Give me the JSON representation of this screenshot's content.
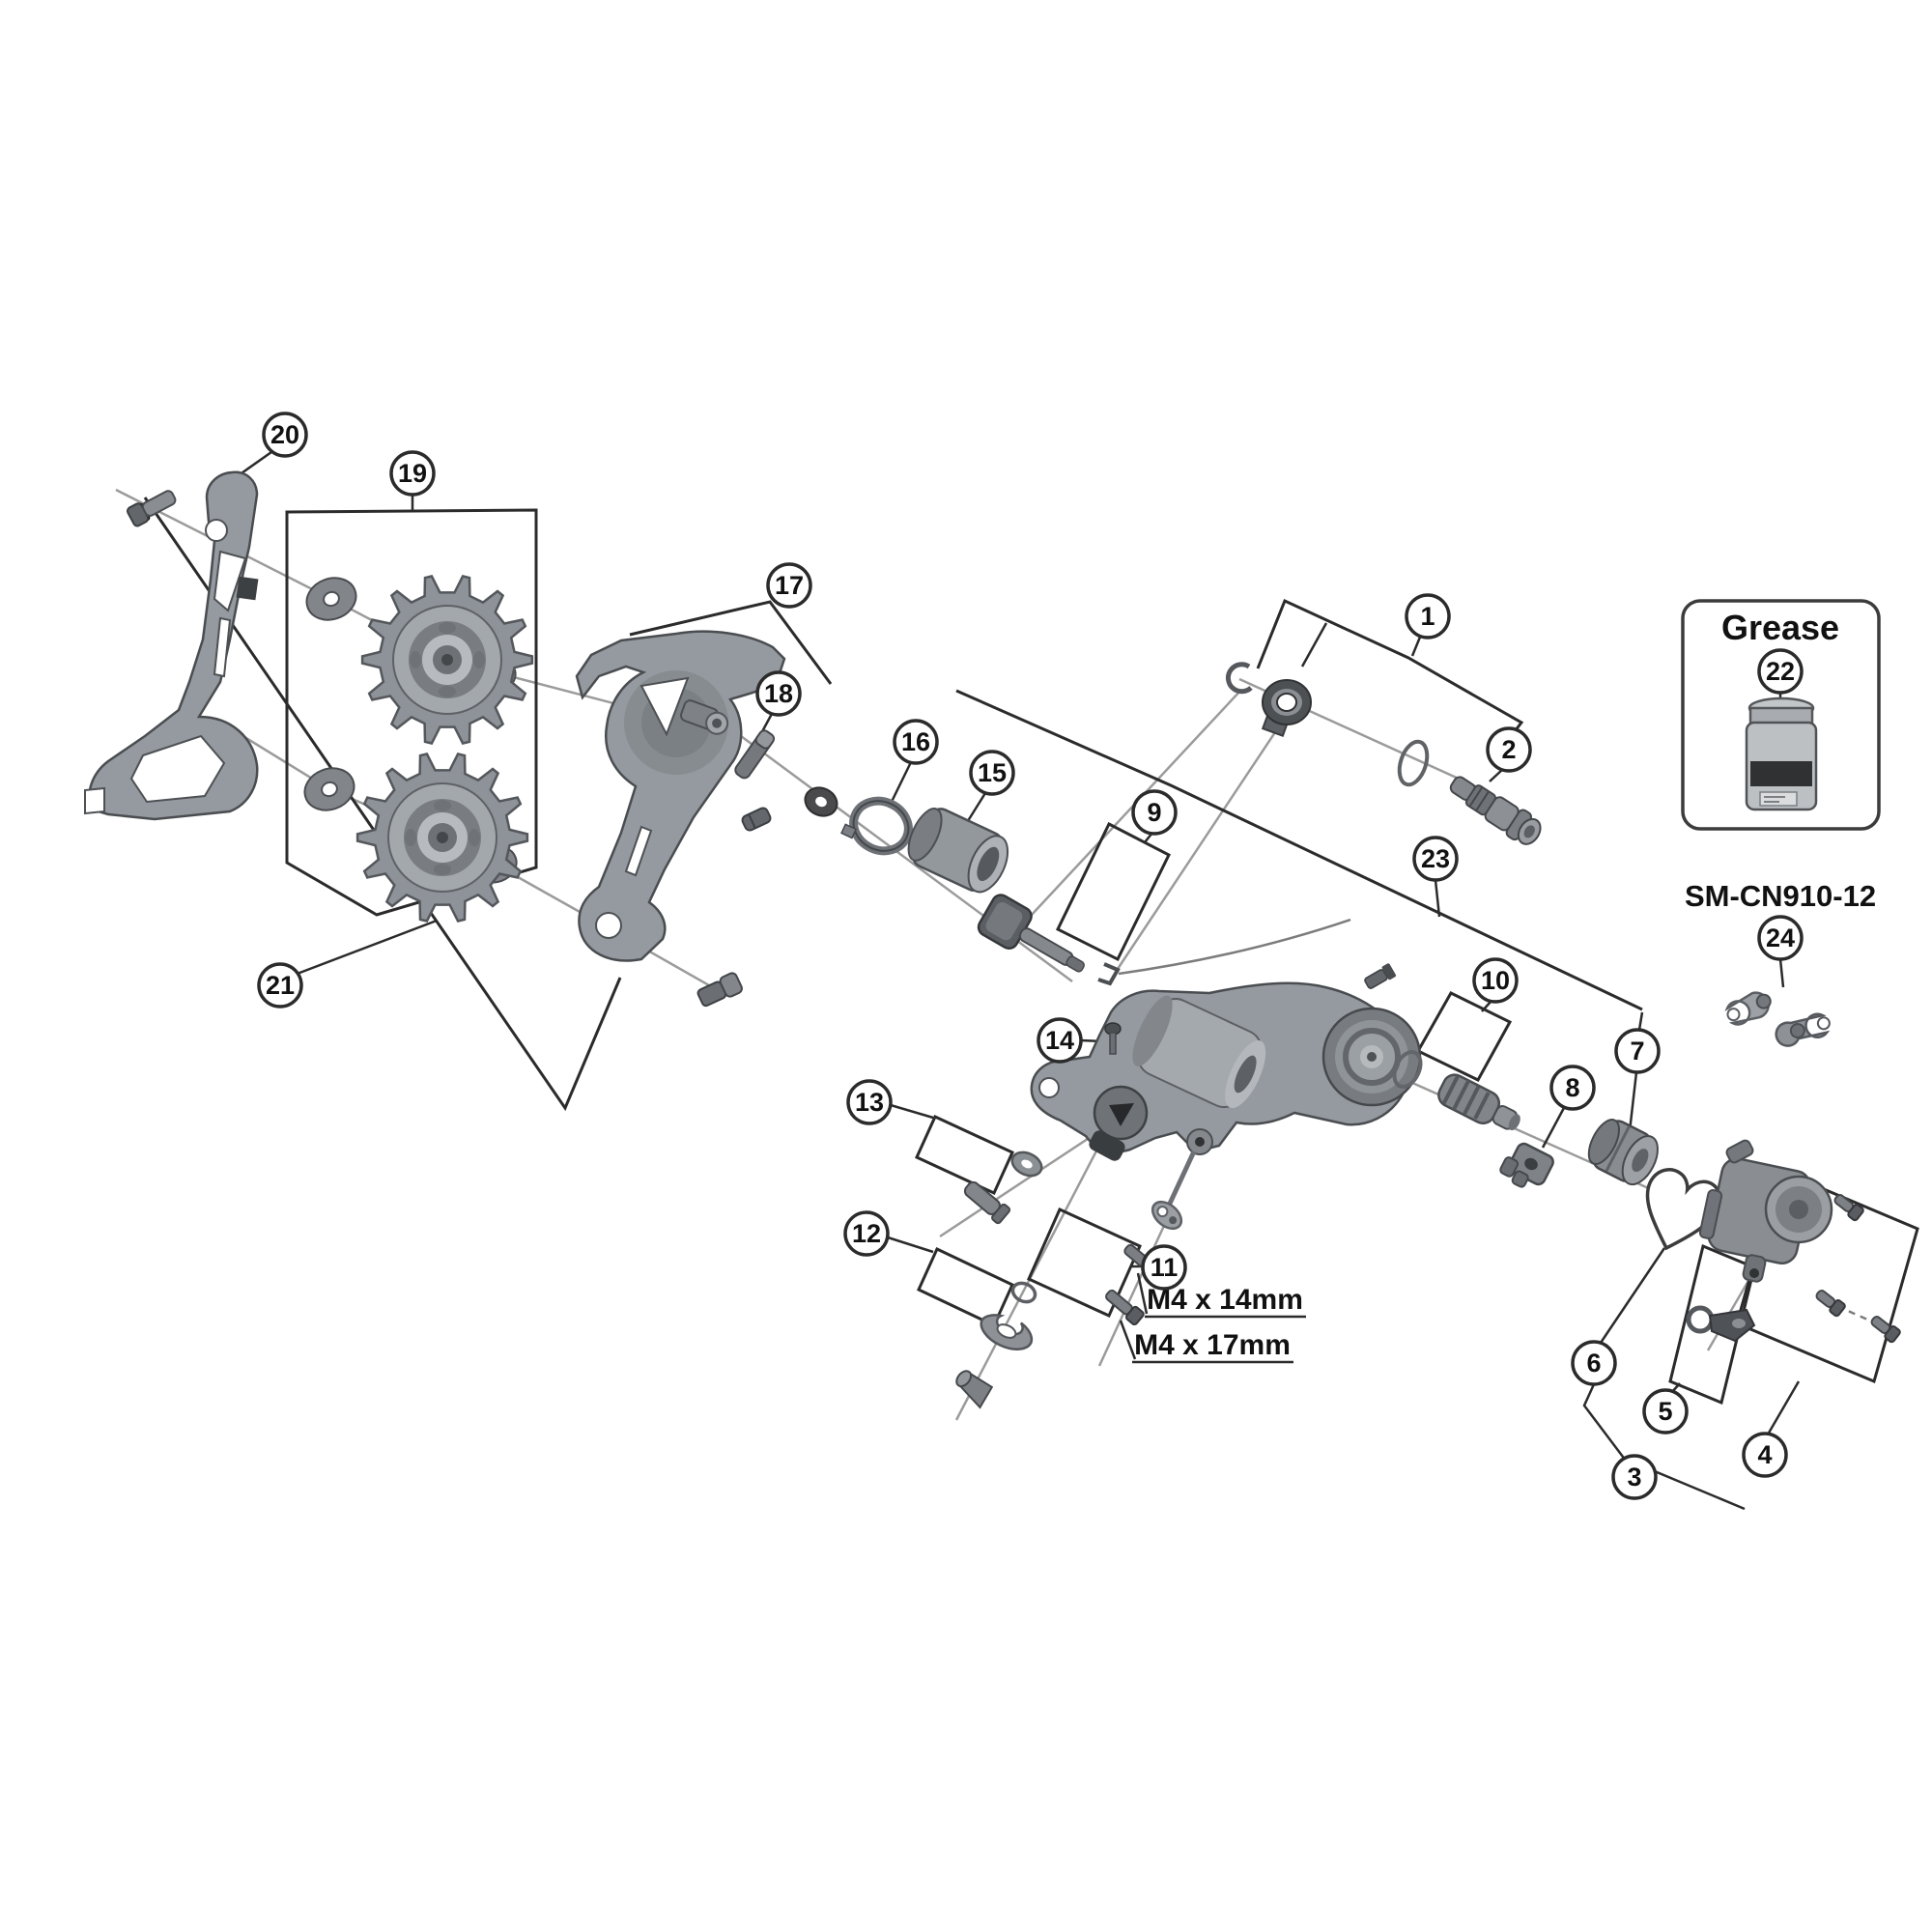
{
  "diagram": {
    "title_hint": "rear derailleur exploded parts diagram",
    "colors": {
      "background": "#ffffff",
      "outline": "#2b2b2b",
      "axis_line": "#9b9b9b",
      "part_gray": "#959aa0",
      "part_dark": "#5a5d61",
      "text": "#111111"
    },
    "callouts": [
      "1",
      "2",
      "3",
      "4",
      "5",
      "6",
      "7",
      "8",
      "9",
      "10",
      "11",
      "12",
      "13",
      "14",
      "15",
      "16",
      "17",
      "18",
      "19",
      "20",
      "21",
      "22",
      "23",
      "24"
    ],
    "labels": {
      "grease_box_title": "Grease",
      "chain_link_model": "SM-CN910-12",
      "screw_spec_1": "M4 x 14mm",
      "screw_spec_2": "M4 x 17mm"
    }
  }
}
